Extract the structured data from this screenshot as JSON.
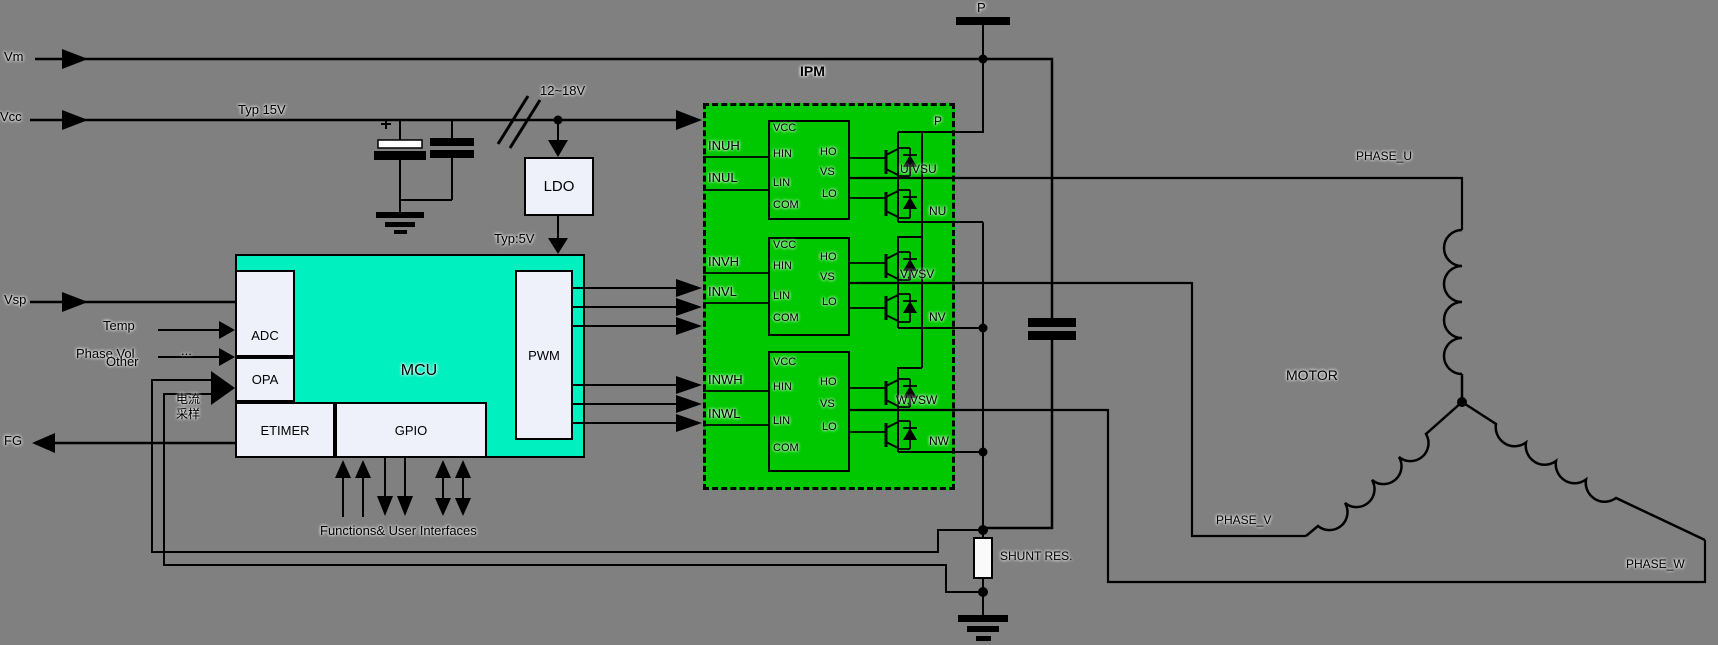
{
  "colors": {
    "background": "#808080",
    "ipm_green": "#00c800",
    "mcu_teal": "#00f0c0",
    "block_fill": "#eef0fa",
    "wire": "#000000"
  },
  "rails": {
    "vm": "Vm",
    "vcc": "Vcc",
    "vsp": "Vsp",
    "fg": "FG",
    "typ_15v": "Typ 15V",
    "range_12_18v": "12~18V",
    "typ_5v": "Typ:5V",
    "p_terminal": "P"
  },
  "ldo": {
    "label": "LDO"
  },
  "mcu": {
    "title": "MCU",
    "blocks": {
      "adc": "ADC",
      "opa": "OPA",
      "etimer": "ETIMER",
      "gpio": "GPIO",
      "pwm": "PWM"
    },
    "inputs": {
      "temp": "Temp",
      "phase_vol": "Phase Vol",
      "other": "Other",
      "ellipsis": "...",
      "current_sense_cn_1": "电流",
      "current_sense_cn_2": "采样"
    },
    "bottom_label": "Functions&  User Interfaces"
  },
  "ipm": {
    "title": "IPM",
    "pin_p": "P",
    "inputs": {
      "inuh": "INUH",
      "inul": "INUL",
      "invh": "INVH",
      "invl": "INVL",
      "inwh": "INWH",
      "inwl": "INWL"
    },
    "driver_pins_left": [
      "VCC",
      "HIN",
      "LIN",
      "COM"
    ],
    "driver_pins_right": [
      "HO",
      "VS",
      "LO"
    ],
    "outputs": {
      "u": "U,VSU",
      "nu": "NU",
      "v": "V,VSV",
      "nv": "NV",
      "w": "W,VSW",
      "nw": "NW"
    }
  },
  "shunt": {
    "label": "SHUNT RES."
  },
  "motor": {
    "title": "MOTOR",
    "phase_u": "PHASE_U",
    "phase_v": "PHASE_V",
    "phase_w": "PHASE_W"
  }
}
